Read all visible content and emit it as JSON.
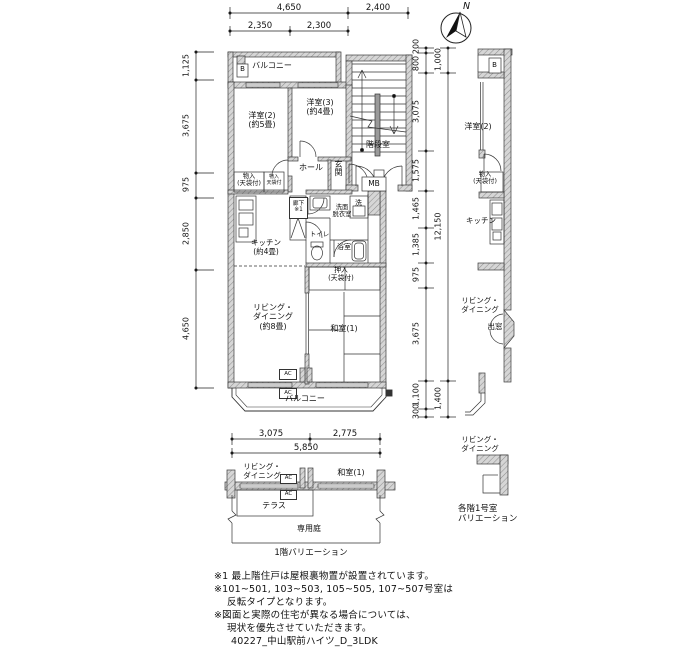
{
  "compass": {
    "north": "N"
  },
  "dims": {
    "top": {
      "d4650": "4,650",
      "d2400": "2,400",
      "d2350": "2,350",
      "d2300": "2,300"
    },
    "left": [
      "1,125",
      "3,675",
      "975",
      "2,850",
      "4,650"
    ],
    "right_inner": [
      "200",
      "800",
      "3,075",
      "1,575",
      "1,465",
      "1,385",
      "975",
      "3,675",
      "1,100",
      "300"
    ],
    "right_outer": [
      "1,000",
      "12,150",
      "1,400"
    ],
    "f1": {
      "d3075": "3,075",
      "d2775": "2,775",
      "d5850": "5,850"
    }
  },
  "main_plan": {
    "balcony_top": "バルコニー",
    "balcony_tag": "B",
    "bedroom2": "洋室(2)\n(約5畳)",
    "bedroom3": "洋室(3)\n(約4畳)",
    "stairwell": "階段室",
    "hall": "ホール",
    "entrance": "玄関",
    "mb": "MB",
    "closet_left": "物入\n(天袋付)",
    "closet_small": "物入\n天袋付",
    "corridor": "廊下\n※1",
    "washroom": "洗面\n脱衣室",
    "laundry": "洗",
    "toilet": "トイレ",
    "bath": "浴室",
    "kitchen": "キッチン\n(約4畳)",
    "oshiire": "押入\n(天袋付)",
    "living": "リビング・\nダイニング\n(約8畳)",
    "washitsu": "和室(1)",
    "ac": "AC",
    "balcony_bottom": "バルコニー"
  },
  "variation_1f": {
    "living": "リビング・\nダイニング",
    "ac": "AC",
    "washitsu": "和室(1)",
    "terrace": "テラス",
    "garden": "専用庭",
    "caption": "1階バリエーション"
  },
  "variation_right": {
    "balcony_tag": "B",
    "bedroom2": "洋室(2)",
    "closet": "物入\n(天袋付)",
    "kitchen": "キッチン",
    "living": "リビング・\nダイニング",
    "bay_window": "出窓",
    "living2": "リビング・\nダイニング",
    "caption": "各階1号室\nバリエーション"
  },
  "notes": {
    "line1": "※1 最上階住戸は屋根裏物置が設置されています。",
    "line2": "※101~501, 103~503, 105~505, 107~507号室は",
    "line3": "反転タイプとなります。",
    "line4": "※図面と実際の住宅が異なる場合については、",
    "line5": "現状を優先させていただきます。",
    "file_code": "40227_中山駅前ハイツ_D_3LDK"
  }
}
